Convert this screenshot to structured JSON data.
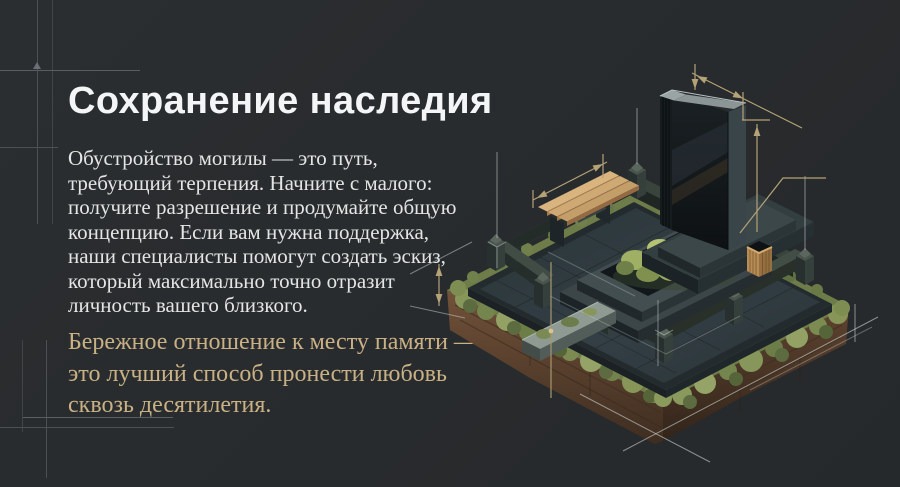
{
  "slide": {
    "title": "Сохранение наследия",
    "paragraph": "Обустройство могилы — это путь, требующий терпения. Начните с малого: получите разрешение и продумайте общую концепцию. Если вам нужна поддержка, наши специалисты помогут создать эскиз, который максимально точно отразит личность вашего близкого.",
    "quote": "Бережное отношение к месту памяти — это лучший способ пронести любовь сквозь десятилетия."
  },
  "illustration": {
    "kind": "isometric-memorial-plot-render",
    "elements": [
      "granite-stele-monument",
      "wooden-bench",
      "moss-grave-bed",
      "wooden-planter-box",
      "granite-curb-with-posts",
      "entrance-step-slab",
      "soil-base-with-moss",
      "technical-dimension-lines"
    ]
  },
  "colors": {
    "background": "#292c2e",
    "heading": "#f3f5f6",
    "body_text": "#e4e6e5",
    "accent_gold": "#c9b185",
    "dimension_tan": "#b5a277",
    "blueprint_gray": "#4a5054",
    "moss_green": "#8a995c",
    "soil_brown": "#6b4c34",
    "granite_dark": "#262e31",
    "wood": "#d0a873"
  }
}
